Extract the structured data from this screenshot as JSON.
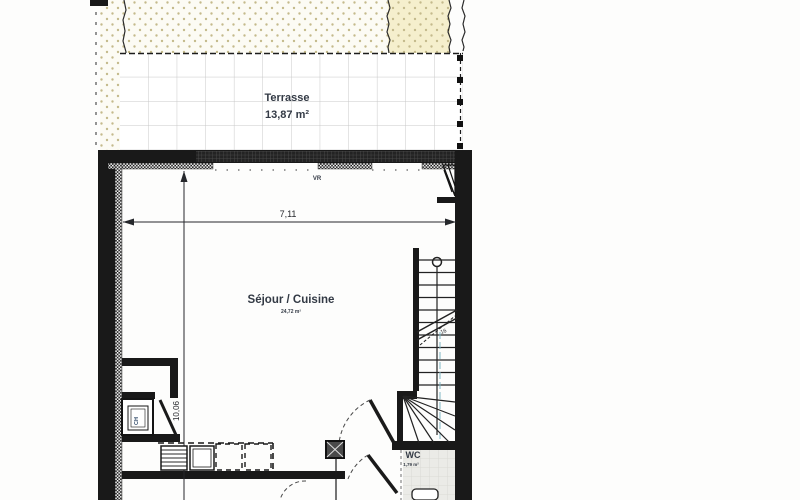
{
  "plan": {
    "terrace": {
      "label": "Terrasse",
      "area": "13,87 m²"
    },
    "living": {
      "label": "Séjour / Cuisine",
      "area": "24,72 m²"
    },
    "wc": {
      "label": "WC",
      "area": "1,79 m²"
    },
    "water_heater_label": "CH",
    "roller_shutter_label": "VR",
    "stair_step_count": "16",
    "dimensions": {
      "width": "7,11",
      "depth": "10,06"
    }
  },
  "colors": {
    "wall": "#191919",
    "garden_dot": "#c4ba8c",
    "garden_bg": "#fcfbf4",
    "garden_yellow_bg": "#f5efcd",
    "tile_line": "#c8c8c8",
    "label_text": "#333a45",
    "water_heater_text": "#2c4766",
    "wc_floor": "#ebebe7"
  }
}
